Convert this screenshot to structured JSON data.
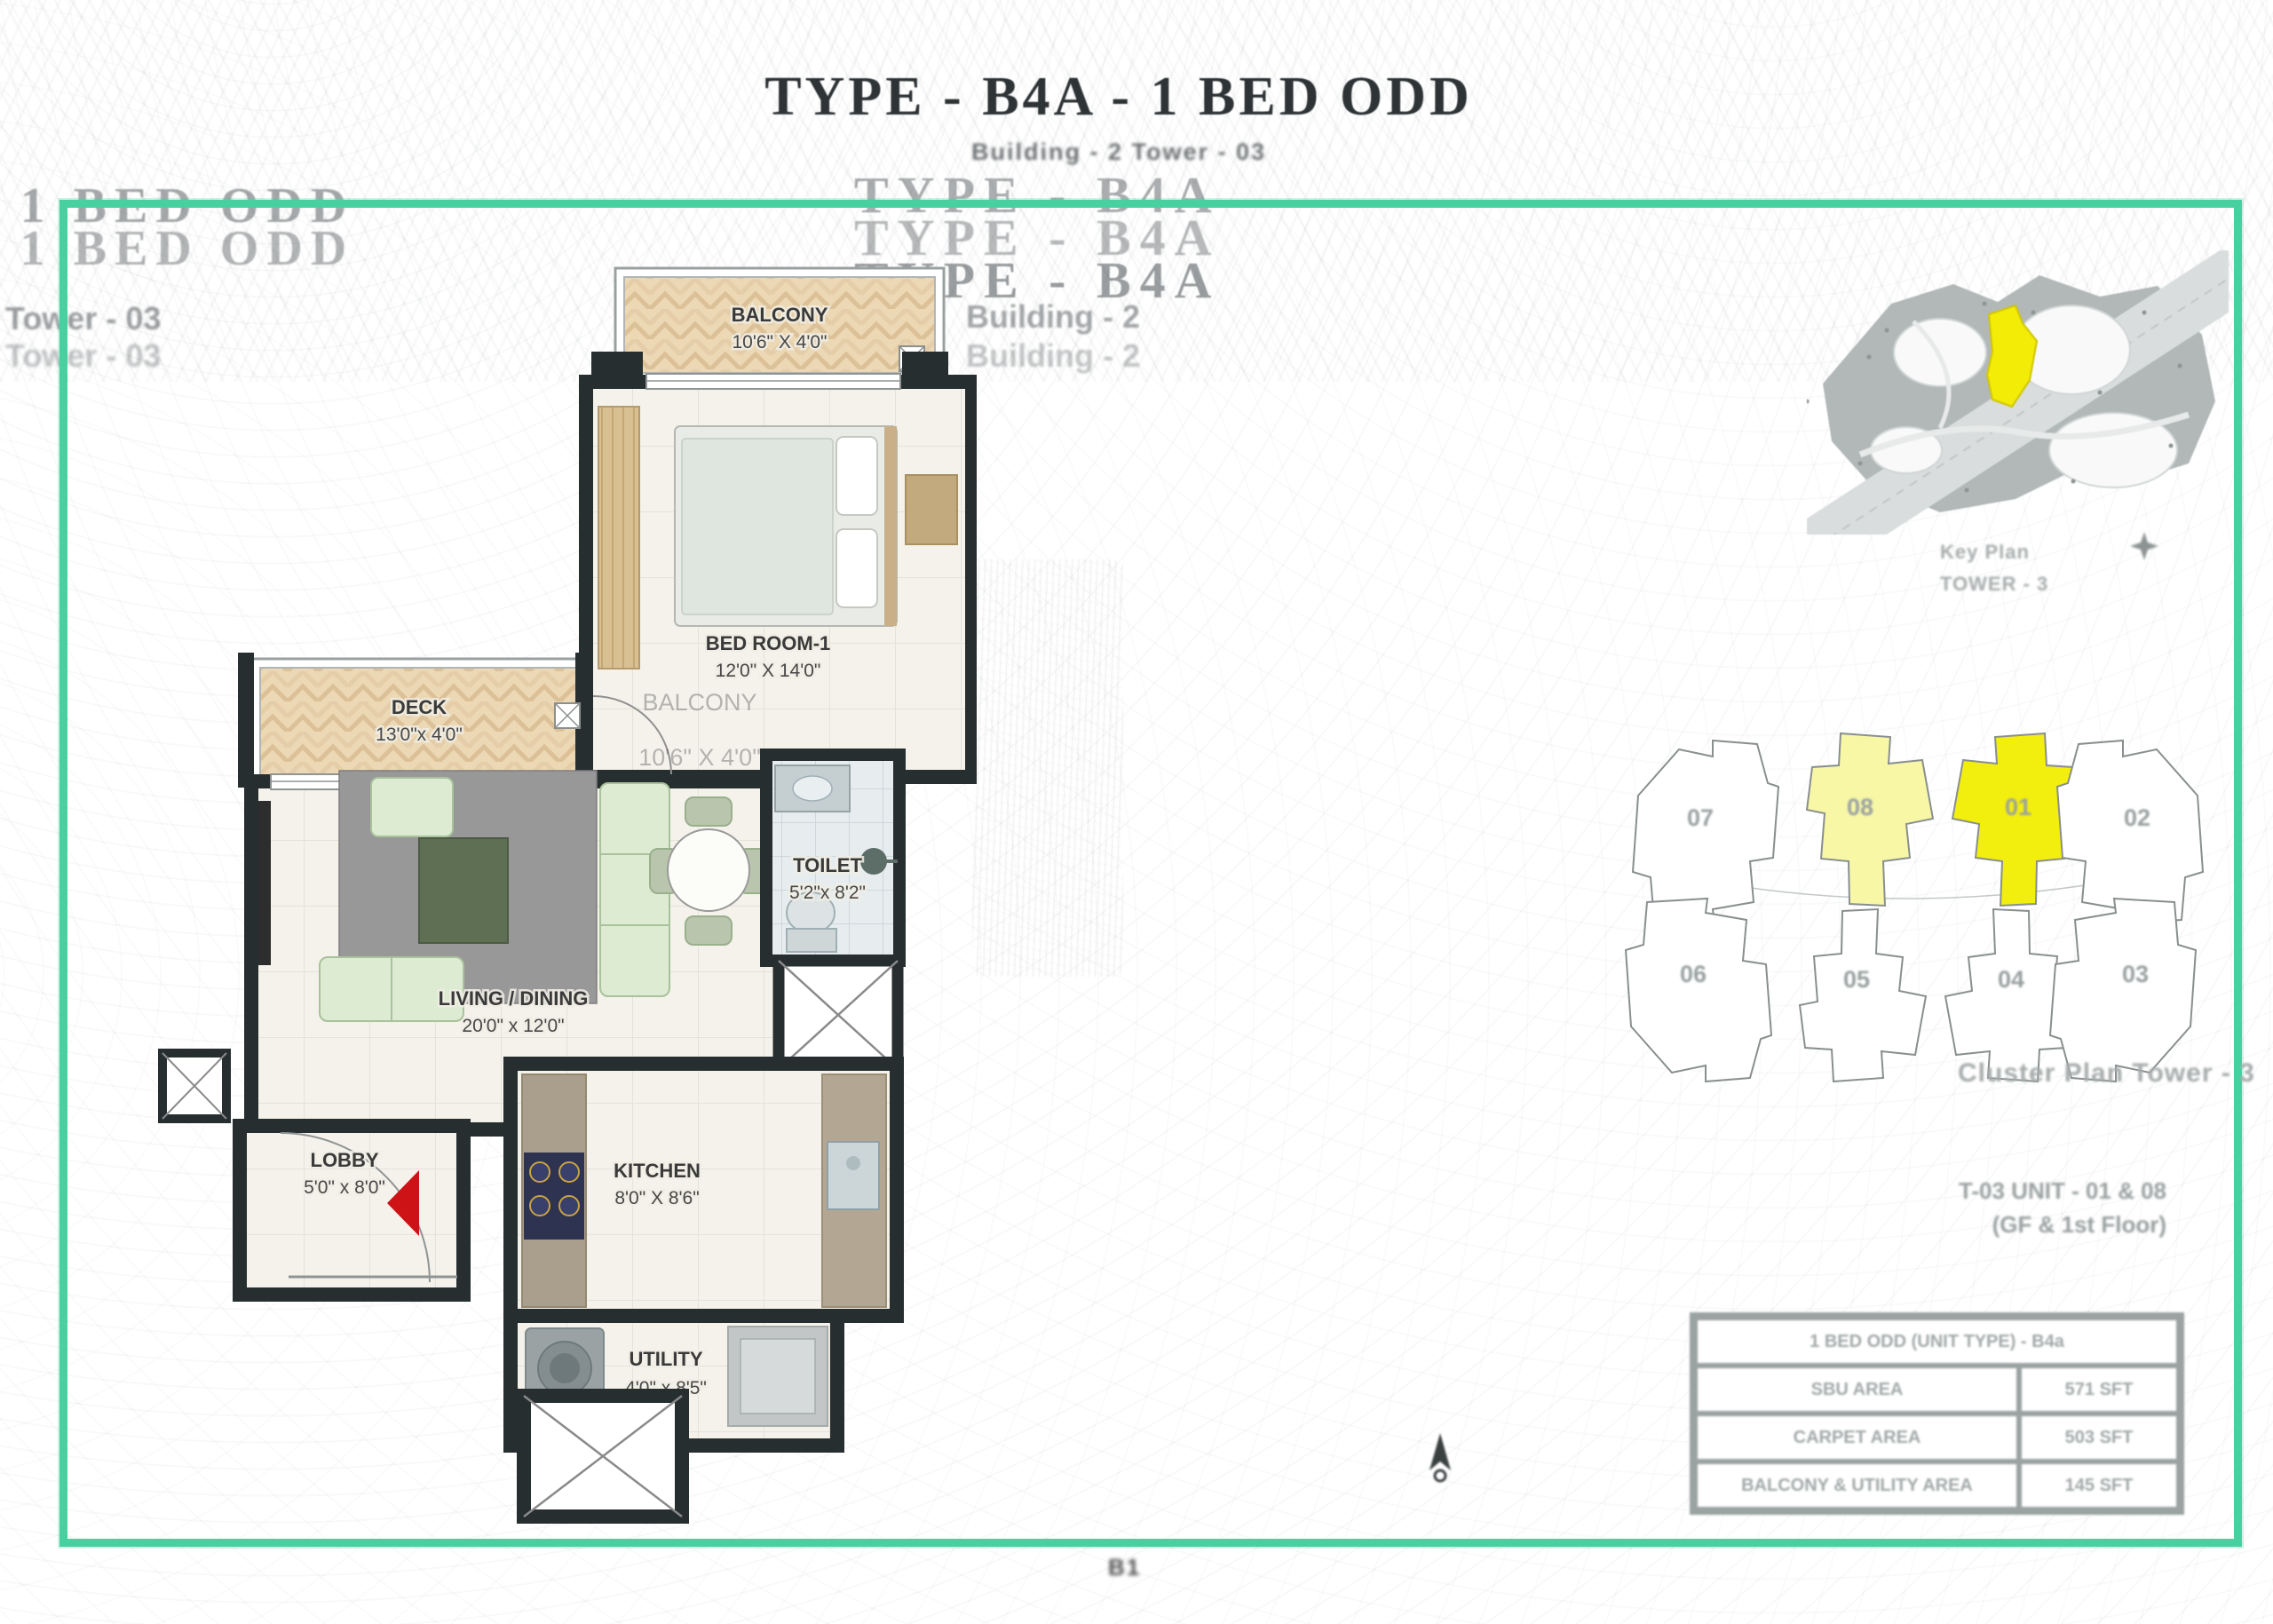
{
  "header": {
    "title": "TYPE - B4A - 1 BED ODD",
    "subtitle": "Building - 2 Tower - 03",
    "ghost_title": "TYPE - B4A",
    "ghost_building": "Building - 2",
    "left_ghost_title": "- 1 BED ODD",
    "left_ghost_tower": "Tower - 03"
  },
  "floor_plan": {
    "balcony": {
      "name": "BALCONY",
      "dims": "10'6\" X 4'0\""
    },
    "bedroom": {
      "name": "BED ROOM-1",
      "dims": "12'0\" X 14'0\""
    },
    "deck": {
      "name": "DECK",
      "dims": "13'0\"x 4'0\""
    },
    "living": {
      "name": "LIVING / DINING",
      "dims": "20'0\" x 12'0\""
    },
    "toilet": {
      "name": "TOILET",
      "dims": "5'2\"x 8'2\""
    },
    "lobby": {
      "name": "LOBBY",
      "dims": "5'0\" x 8'0\""
    },
    "kitchen": {
      "name": "KITCHEN",
      "dims": "8'0\" X 8'6\""
    },
    "utility": {
      "name": "UTILITY",
      "dims": "4'0\" x 8'5\""
    },
    "ghost_balcony": {
      "name": "BALCONY",
      "dims": "10'6\" X 4'0\""
    }
  },
  "key_plan": {
    "caption": "Key Plan",
    "tower": "TOWER - 3"
  },
  "cluster_plan": {
    "caption": "Cluster Plan   Tower - 3",
    "units": [
      {
        "label": "07",
        "fill": "#ffffff"
      },
      {
        "label": "08",
        "fill": "#f7f7a6"
      },
      {
        "label": "01",
        "fill": "#f2ee0e"
      },
      {
        "label": "02",
        "fill": "#ffffff"
      },
      {
        "label": "06",
        "fill": "#ffffff"
      },
      {
        "label": "05",
        "fill": "#ffffff"
      },
      {
        "label": "04",
        "fill": "#ffffff"
      },
      {
        "label": "03",
        "fill": "#ffffff"
      }
    ]
  },
  "unit_info": {
    "line1": "T-03 UNIT - 01 & 08",
    "line2": "(GF & 1st Floor)"
  },
  "area_table": {
    "header": "1 BED ODD (UNIT TYPE) - B4a",
    "rows": [
      {
        "label": "SBU AREA",
        "value": "571 SFT"
      },
      {
        "label": "CARPET AREA",
        "value": "503 SFT"
      },
      {
        "label": "BALCONY & UTILITY AREA",
        "value": "145 SFT"
      }
    ]
  },
  "footer": {
    "mark": "B1"
  },
  "colors": {
    "frame_teal": "#48d1a0",
    "wall": "#272e2f",
    "balcony_floor": "#ecd8b4",
    "highlight_yellow": "#f2ee0e",
    "highlight_light_yellow": "#f7f7a6",
    "entry_arrow": "#ce1317"
  }
}
